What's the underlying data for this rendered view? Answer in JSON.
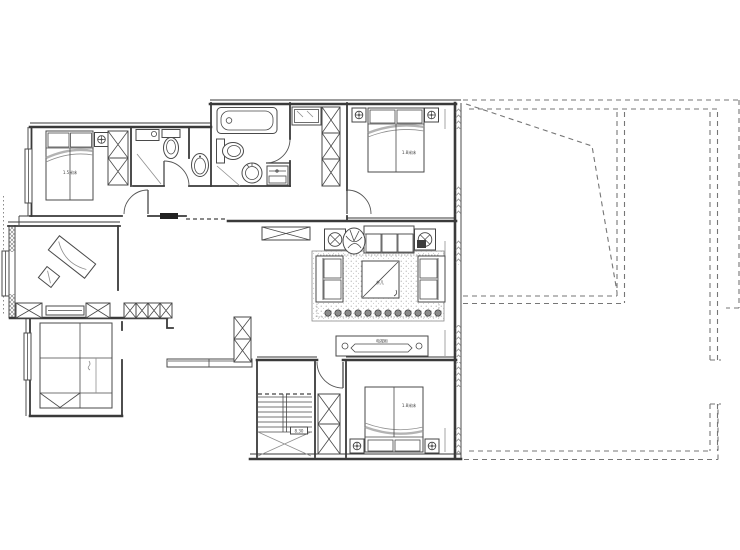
{
  "labels": {
    "bed_nw": "1.5米床",
    "bed_ne": "1.8米床",
    "bed_s": "1.8米床",
    "coffee_table": "茶几",
    "tv_cabinet": "电视柜",
    "stair_mark": "8.30"
  },
  "colors": {
    "wall": "#3a3a3a",
    "furniture": "#4a4a4a",
    "soft": "#8f8f8f",
    "roof_dash": "#767676",
    "background": "#ffffff"
  }
}
